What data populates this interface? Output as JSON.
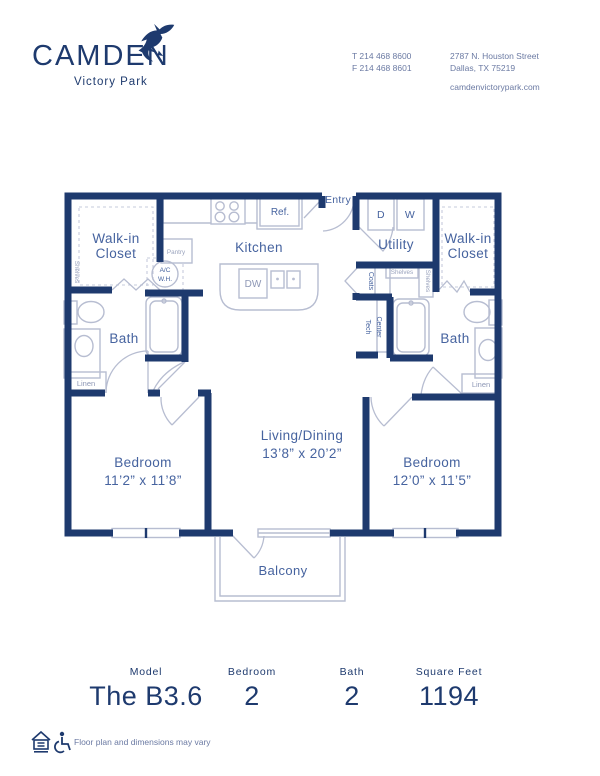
{
  "header": {
    "brand": "CAMDEN",
    "brand_sub": "Victory Park",
    "phone_t": "T 214 468 8600",
    "phone_f": "F 214 468 8601",
    "address_line1": "2787 N. Houston Street",
    "address_line2": "Dallas, TX 75219",
    "website": "camdenvictorypark.com"
  },
  "floorplan": {
    "labels": {
      "walk_in_closet_line1": "Walk-in",
      "walk_in_closet_line2": "Closet",
      "kitchen": "Kitchen",
      "ref": "Ref.",
      "dw": "DW",
      "entry": "Entry",
      "utility": "Utility",
      "dryer": "D",
      "washer": "W",
      "pantry": "Pantry",
      "ac_line1": "A/C",
      "ac_line2": "W.H.",
      "coats": "Coats",
      "tech_line1": "Tech",
      "tech_line2": "Center",
      "shelves": "Shelves",
      "bath": "Bath",
      "linen": "Linen",
      "bedroom": "Bedroom",
      "bedroom1_dims": "11’2” x 11’8”",
      "bedroom2_dims": "12’0” x 11’5”",
      "living_name": "Living/Dining",
      "living_dims": "13’8” x 20’2”",
      "balcony": "Balcony"
    }
  },
  "stats": [
    {
      "label": "Model",
      "value": "The B3.6"
    },
    {
      "label": "Bedroom",
      "value": "2"
    },
    {
      "label": "Bath",
      "value": "2"
    },
    {
      "label": "Square Feet",
      "value": "1194"
    }
  ],
  "footer": {
    "disclaimer": "Floor plan and dimensions may vary"
  },
  "colors": {
    "navy": "#1e3a6e",
    "label_blue": "#46639f",
    "light_line": "#b7bdd1",
    "muted": "#8d97b5"
  }
}
